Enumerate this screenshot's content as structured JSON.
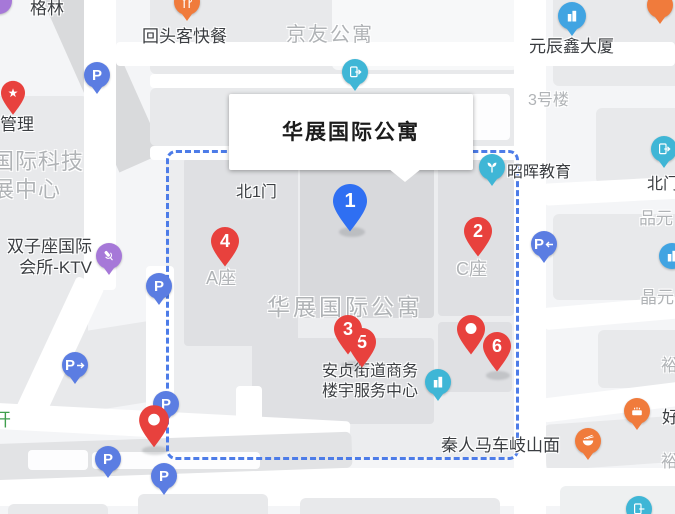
{
  "callout": {
    "title": "华展国际公寓"
  },
  "markers": {
    "pin1": "1",
    "pin2": "2",
    "pin3": "3",
    "pin4": "4",
    "pin5": "5",
    "pin6": "6"
  },
  "labels": {
    "gelin": "格林",
    "guanli": "管理",
    "guoji_keji": "国际科技",
    "zhan_zhongxin": "展中心",
    "huitouke": "回头客快餐",
    "jingyou": "京友公寓",
    "yuanchenxin": "元辰鑫大厦",
    "lou3": "3号楼",
    "bei1men": "北1门",
    "zhaohui": "昭晖教育",
    "beimen": "北门",
    "pinyuan": "品元",
    "jingyuan": "晶元",
    "azuo": "A座",
    "czuo": "C座",
    "huazhan_area": "华展国际公寓",
    "shuangzi_1": "双子座国际",
    "shuangzi_2": "会所-KTV",
    "anzhen_1": "安贞街道商务",
    "anzhen_2": "楼宇服务中心",
    "qinren": "秦人马车岐山面",
    "hao": "好",
    "yu_1": "裕",
    "yu_2": "裕",
    "kai": "开",
    "parking": "P",
    "star": "★"
  },
  "icons": {
    "parking": "P-circle-pin",
    "parking_entrance_left": "P-circle-with-left-arrow",
    "parking_entrance_right": "P-circle-with-right-arrow",
    "metro_exit": "door-with-arrow",
    "education": "sprout-leaves",
    "office_building": "building-silhouette",
    "restaurant": "fork-and-knife",
    "noodle_shop": "bowl-with-chopsticks",
    "bakery": "cake",
    "ktv": "microphone",
    "management": "star-pin",
    "numbered_marker": "teardrop-pin"
  },
  "colors": {
    "marker_red": "#e8413d",
    "marker_blue": "#2f6ff2",
    "parking_blue": "#5b7de2",
    "poi_teal": "#3fb6d6",
    "poi_orange": "#f07b3c",
    "poi_purple": "#a678d8",
    "poi_skyblue": "#41a4e2",
    "boundary_dash_blue": "#4d7ce8",
    "gray_label": "#b0b3b6",
    "road_white": "#ffffff",
    "building_gray": "#e8e9eb"
  }
}
